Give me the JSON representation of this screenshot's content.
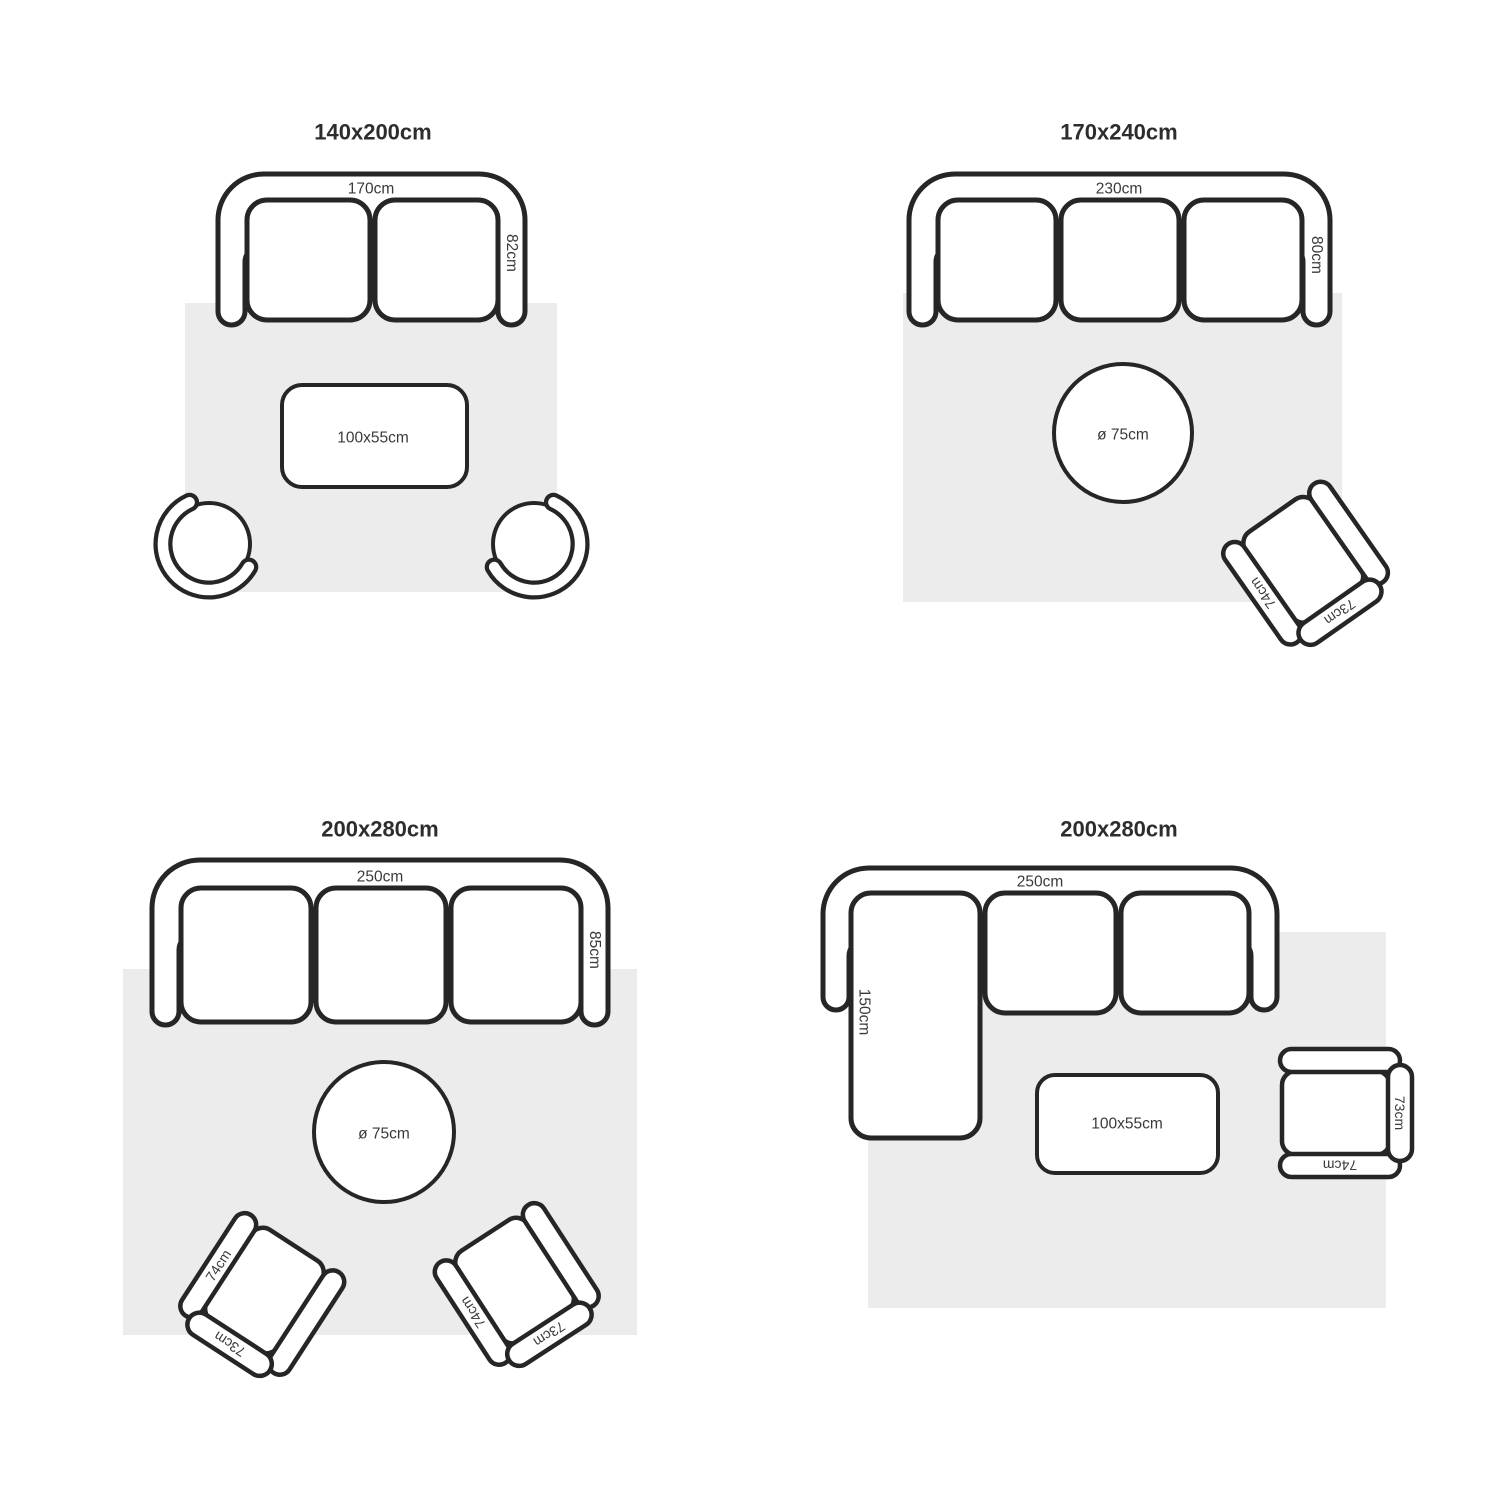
{
  "colors": {
    "stroke": "#262626",
    "surface": "#ffffff",
    "rug": "#ececec",
    "text": "#3a3a3a",
    "title": "#2d2d2d",
    "bg": "#ffffff"
  },
  "quadrants": [
    {
      "title": "140x200cm",
      "sofa": {
        "width": "170cm",
        "depth": "82cm"
      },
      "table": {
        "label": "100x55cm"
      }
    },
    {
      "title": "170x240cm",
      "sofa": {
        "width": "230cm",
        "depth": "80cm"
      },
      "table": {
        "label": "ø 75cm"
      },
      "chair": {
        "arm": "74cm",
        "back": "73cm"
      }
    },
    {
      "title": "200x280cm",
      "sofa": {
        "width": "250cm",
        "depth": "85cm"
      },
      "table": {
        "label": "ø 75cm"
      },
      "chair_left": {
        "arm": "74cm",
        "back": "73cm"
      },
      "chair_right": {
        "arm": "74cm",
        "back": "73cm"
      }
    },
    {
      "title": "200x280cm",
      "sofa": {
        "width": "250cm",
        "chaise": "150cm"
      },
      "table": {
        "label": "100x55cm"
      },
      "chair": {
        "arm": "74cm",
        "back": "73cm"
      }
    }
  ]
}
